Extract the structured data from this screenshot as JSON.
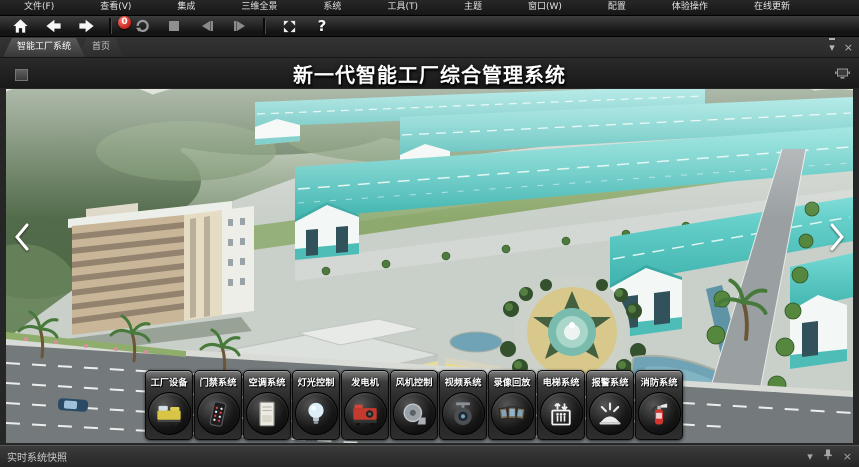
{
  "menu_bar": {
    "items": [
      {
        "label": "文件(F)",
        "name": "menu-file"
      },
      {
        "label": "查看(V)",
        "name": "menu-view"
      },
      {
        "label": "集成",
        "name": "menu-integration"
      },
      {
        "label": "三维全景",
        "name": "menu-3d-panorama"
      },
      {
        "label": "系统",
        "name": "menu-system"
      },
      {
        "label": "工具(T)",
        "name": "menu-tools"
      },
      {
        "label": "主题",
        "name": "menu-theme"
      },
      {
        "label": "窗口(W)",
        "name": "menu-window"
      },
      {
        "label": "配置",
        "name": "menu-config"
      },
      {
        "label": "体验操作",
        "name": "menu-experience"
      },
      {
        "label": "在线更新",
        "name": "menu-online-update"
      }
    ]
  },
  "toolbar": {
    "badge_count": "0",
    "help_label": "?"
  },
  "tab_bar": {
    "tabs": [
      {
        "label": "智能工厂系统",
        "active": true,
        "name": "tab-smart-factory-system"
      },
      {
        "label": "首页",
        "active": false,
        "name": "tab-home"
      }
    ]
  },
  "title_banner": {
    "text": "新一代智能工厂综合管理系统"
  },
  "dock": {
    "items": [
      {
        "label": "工厂设备",
        "icon": "#icon-machine",
        "name": "dock-factory-equipment"
      },
      {
        "label": "门禁系统",
        "icon": "#icon-keypad",
        "name": "dock-access-control"
      },
      {
        "label": "空调系统",
        "icon": "#icon-ac",
        "name": "dock-hvac-system"
      },
      {
        "label": "灯光控制",
        "icon": "#icon-bulb",
        "name": "dock-lighting-control"
      },
      {
        "label": "发电机",
        "icon": "#icon-generator",
        "name": "dock-generator"
      },
      {
        "label": "风机控制",
        "icon": "#icon-fan",
        "name": "dock-fan-control"
      },
      {
        "label": "视频系统",
        "icon": "#icon-camera",
        "name": "dock-video-system"
      },
      {
        "label": "录像回放",
        "icon": "#icon-playback",
        "name": "dock-video-playback"
      },
      {
        "label": "电梯系统",
        "icon": "#icon-elevator",
        "name": "dock-elevator-system"
      },
      {
        "label": "报警系统",
        "icon": "#icon-siren",
        "name": "dock-alarm-system"
      },
      {
        "label": "消防系统",
        "icon": "#icon-extinguisher",
        "name": "dock-fire-system"
      }
    ]
  },
  "status_bar": {
    "text": "实时系统快照"
  },
  "glyphs": {
    "tab_list": "▾",
    "close": "×",
    "panel_dropdown": "▾"
  },
  "colors": {
    "accent_teal": "#57c7c0",
    "badge_red": "#c01f17",
    "bar_bg": "#1b1b1b"
  }
}
